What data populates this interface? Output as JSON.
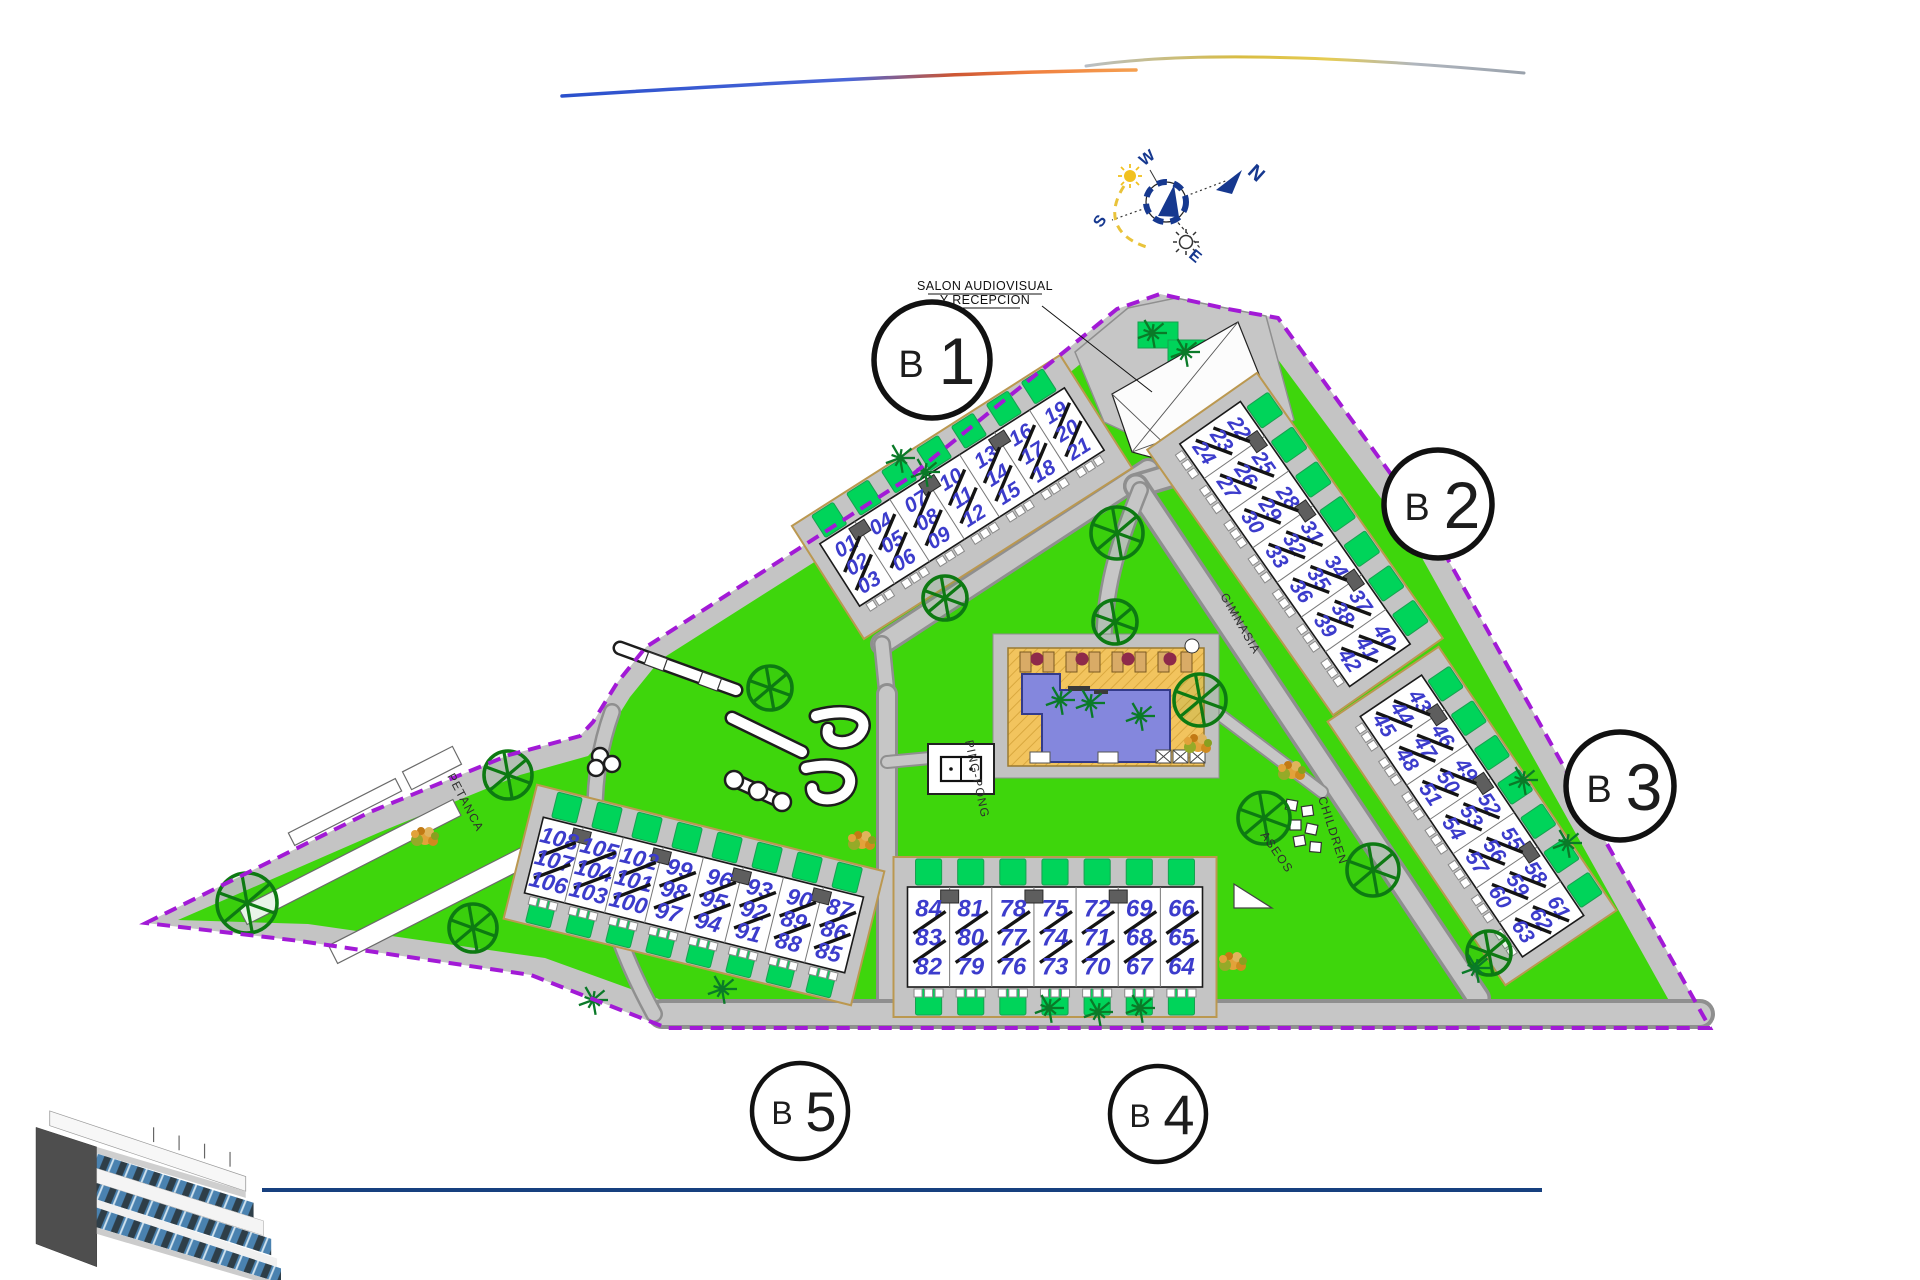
{
  "colors": {
    "lawn": "#3ed60c",
    "garden": "#00d45a",
    "road": "#c4c4c4",
    "road_edge": "#8f8f8f",
    "boundary": "#a21ad6",
    "building": "#ffffff",
    "outline": "#1a1a1a",
    "unit_number": "#3c3ccc",
    "sand": "#f2c45e",
    "water": "#8487dd",
    "accent_blue": "#16388f",
    "logo_line": "#17407f",
    "plot_border": "#bb9850"
  },
  "reception_label": {
    "line1": "SALON AUDIOVISUAL",
    "line2": "Y RECEPCION"
  },
  "compass": {
    "n": "N",
    "w": "W",
    "s": "S",
    "e": "E"
  },
  "badges": [
    {
      "letter": "B",
      "number": "1"
    },
    {
      "letter": "B",
      "number": "2"
    },
    {
      "letter": "B",
      "number": "3"
    },
    {
      "letter": "B",
      "number": "4"
    },
    {
      "letter": "B",
      "number": "5"
    }
  ],
  "area_labels": [
    {
      "text": "PETANCA"
    },
    {
      "text": "PING-PONG"
    },
    {
      "text": "CHILDREN"
    },
    {
      "text": "ASEOS"
    },
    {
      "text": "GIMNASIA"
    }
  ],
  "blocks": [
    {
      "id": "B1",
      "cx": 962,
      "cy": 497,
      "angle": -32.5,
      "len": 290,
      "wid": 74,
      "fs": 21,
      "gardens": "outer",
      "groups": [
        [
          "01",
          "02",
          "03"
        ],
        [
          "04",
          "05",
          "06"
        ],
        [
          "07",
          "08",
          "09"
        ],
        [
          "10",
          "11",
          "12"
        ],
        [
          "13",
          "14",
          "15"
        ],
        [
          "16",
          "17",
          "18"
        ],
        [
          "19",
          "20",
          "21"
        ]
      ]
    },
    {
      "id": "B2",
      "cx": 1295,
      "cy": 544,
      "angle": 55,
      "len": 296,
      "wid": 74,
      "fs": 21,
      "gardens": "outer",
      "groups": [
        [
          "22",
          "23",
          "24"
        ],
        [
          "25",
          "26",
          "27"
        ],
        [
          "28",
          "29",
          "30"
        ],
        [
          "31",
          "32",
          "33"
        ],
        [
          "34",
          "35",
          "36"
        ],
        [
          "37",
          "38",
          "39"
        ],
        [
          "40",
          "41",
          "42"
        ]
      ]
    },
    {
      "id": "B3",
      "cx": 1472,
      "cy": 816,
      "angle": 56,
      "len": 290,
      "wid": 74,
      "fs": 21,
      "gardens": "outer",
      "groups": [
        [
          "43",
          "44",
          "45"
        ],
        [
          "46",
          "47",
          "48"
        ],
        [
          "49",
          "50",
          "51"
        ],
        [
          "52",
          "53",
          "54"
        ],
        [
          "55",
          "56",
          "57"
        ],
        [
          "58",
          "59",
          "60"
        ],
        [
          "61",
          "62",
          "63"
        ]
      ]
    },
    {
      "id": "B4",
      "cx": 1055,
      "cy": 937,
      "angle": 0,
      "len": 295,
      "wid": 100,
      "fs": 24,
      "gardens": "both",
      "groups": [
        [
          "84",
          "83",
          "82"
        ],
        [
          "81",
          "80",
          "79"
        ],
        [
          "78",
          "77",
          "76"
        ],
        [
          "75",
          "74",
          "73"
        ],
        [
          "72",
          "71",
          "70"
        ],
        [
          "69",
          "68",
          "67"
        ],
        [
          "66",
          "65",
          "64"
        ]
      ]
    },
    {
      "id": "B5",
      "cx": 694,
      "cy": 895,
      "angle": 14,
      "len": 330,
      "wid": 78,
      "fs": 23,
      "gardens": "both",
      "groups": [
        [
          "108",
          "107",
          "106"
        ],
        [
          "105",
          "104",
          "103"
        ],
        [
          "102",
          "101",
          "100"
        ],
        [
          "99",
          "98",
          "97"
        ],
        [
          "96",
          "95",
          "94"
        ],
        [
          "93",
          "92",
          "91"
        ],
        [
          "90",
          "89",
          "88"
        ],
        [
          "87",
          "86",
          "85"
        ]
      ]
    }
  ],
  "vegetation": {
    "trees": [
      [
        1117,
        533,
        26
      ],
      [
        945,
        598,
        22
      ],
      [
        770,
        688,
        22
      ],
      [
        1115,
        622,
        22
      ],
      [
        1200,
        700,
        26
      ],
      [
        247,
        903,
        30
      ],
      [
        473,
        928,
        24
      ],
      [
        508,
        775,
        24
      ],
      [
        1264,
        818,
        26
      ],
      [
        1373,
        870,
        26
      ],
      [
        1489,
        953,
        22
      ]
    ],
    "palms": [
      [
        900,
        458
      ],
      [
        925,
        472
      ],
      [
        1185,
        352
      ],
      [
        1152,
        333
      ],
      [
        1049,
        1008
      ],
      [
        1098,
        1012
      ],
      [
        1140,
        1008
      ],
      [
        1523,
        780
      ],
      [
        1567,
        843
      ],
      [
        1476,
        968
      ],
      [
        722,
        989
      ],
      [
        593,
        1000
      ],
      [
        1060,
        700
      ],
      [
        1090,
        703
      ],
      [
        1140,
        716
      ]
    ],
    "bushes": [
      [
        862,
        842
      ],
      [
        1198,
        745
      ],
      [
        1233,
        963
      ],
      [
        1292,
        772
      ],
      [
        425,
        838
      ]
    ]
  }
}
